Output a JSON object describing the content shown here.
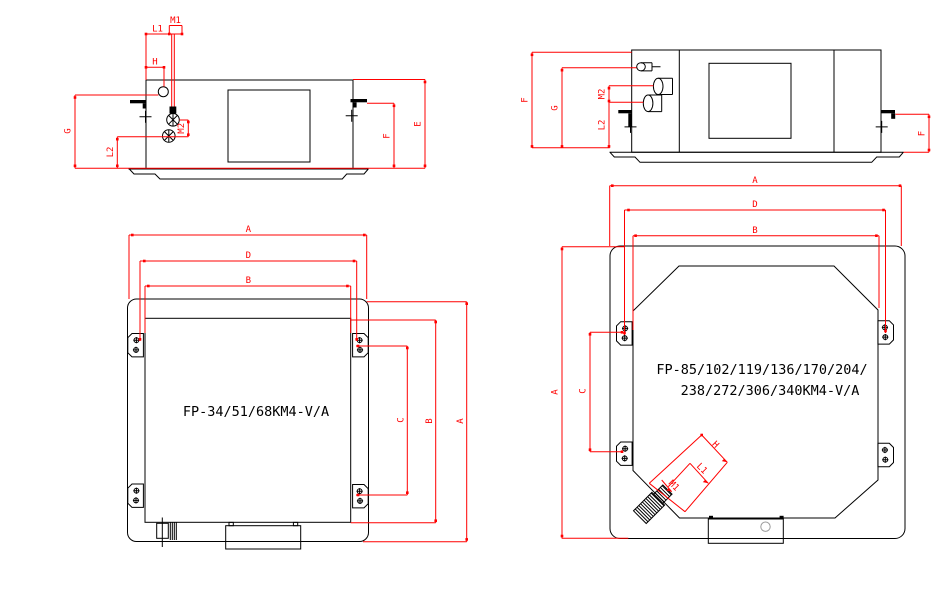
{
  "colors": {
    "line": "#000000",
    "dimension": "#ff0000",
    "detail_circle": "#9a9a9a",
    "background": "#ffffff"
  },
  "dims": {
    "A": "A",
    "B": "B",
    "C": "C",
    "D": "D",
    "E": "E",
    "F": "F",
    "G": "G",
    "H": "H",
    "L1": "L1",
    "L2": "L2",
    "M1": "M1",
    "M2": "M2"
  },
  "models": {
    "small_unit": "FP-34/51/68KM4-V/A",
    "large_unit_line1": "FP-85/102/119/136/170/204/",
    "large_unit_line2": "238/272/306/340KM4-V/A"
  }
}
